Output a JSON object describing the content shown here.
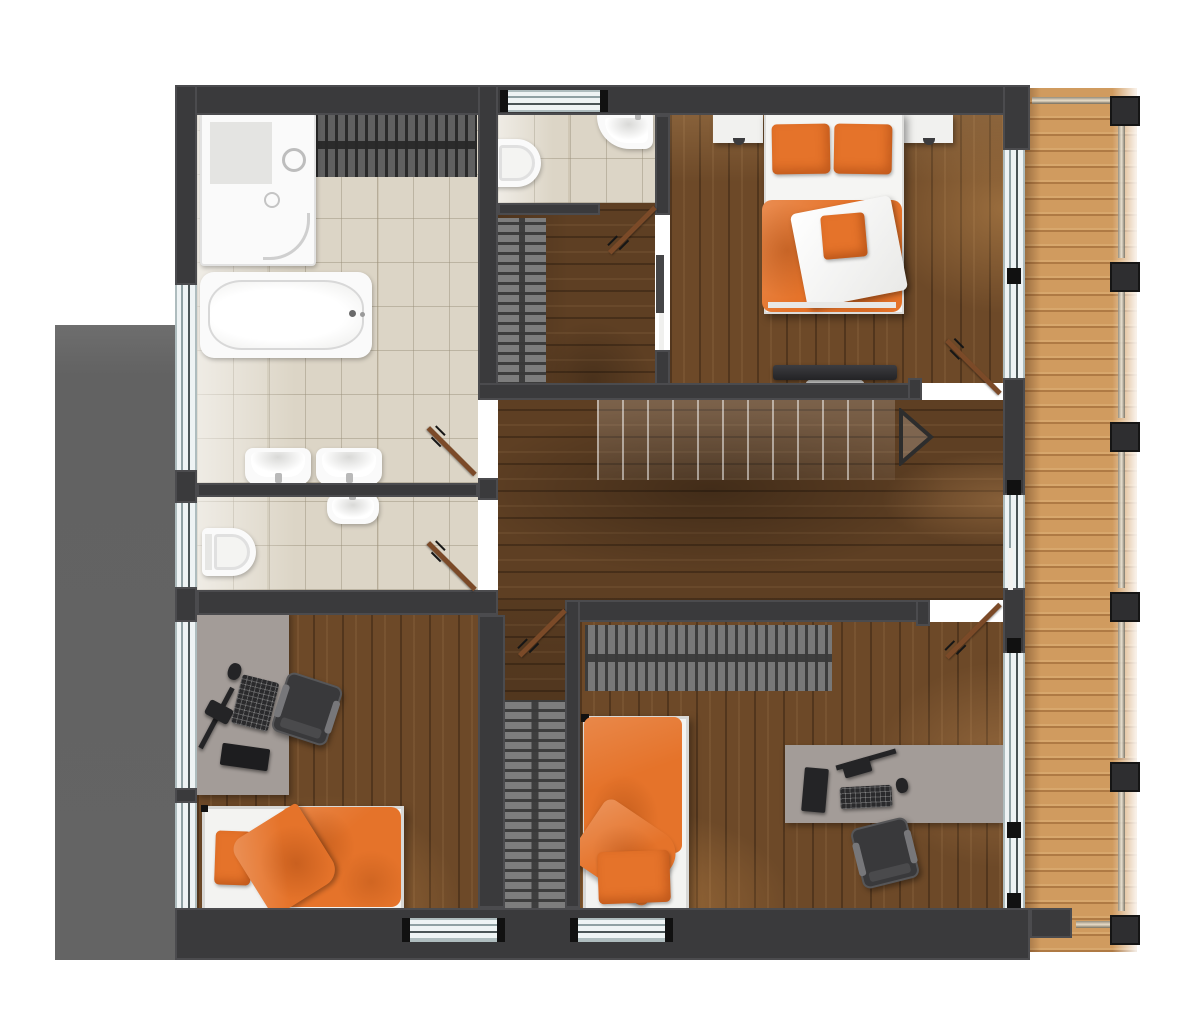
{
  "image": {
    "kind": "architectural floor plan render, top-down view, upper storey",
    "background": "#ffffff"
  },
  "palette": {
    "wall": "#3a3a3c",
    "tile_floor": "#dcd5c6",
    "wood_floor_rooms": "#6d4928",
    "wood_floor_hall": "#5e3f23",
    "balcony_deck": "#d09b5f",
    "accent_orange": "#e5732a",
    "desk_gray": "#a39c98",
    "wardrobe_gray": "#787878",
    "glass": "#eef3f4",
    "door_leaf": "#7b4a28",
    "side_panel_gray": "#646464"
  },
  "floor_plan": {
    "rooms": [
      {
        "id": "bathroom-main",
        "label": "main bathroom",
        "floor": "tile",
        "fixtures": [
          "walk-in shower",
          "bathtub",
          "double washbasins",
          "hanger wardrobe rail"
        ]
      },
      {
        "id": "wc-top",
        "label": "wc",
        "floor": "tile",
        "fixtures": [
          "toilet",
          "corner washbasin"
        ],
        "window": true
      },
      {
        "id": "bathroom-second",
        "label": "second bathroom",
        "floor": "tile",
        "fixtures": [
          "toilet",
          "washbasin"
        ]
      },
      {
        "id": "vestibule",
        "label": "dressing vestibule",
        "floor": "wood",
        "fixtures": [
          "hanger wardrobe rail",
          "sliding door"
        ]
      },
      {
        "id": "master-bedroom",
        "label": "master bedroom",
        "floor": "wood",
        "fixtures": [
          "double bed with orange bedding",
          "two nightstands",
          "wall-mounted tv"
        ]
      },
      {
        "id": "hallway",
        "label": "hallway landing",
        "floor": "wood",
        "fixtures": [
          "staircase",
          "direction arrow"
        ]
      },
      {
        "id": "bedroom-left",
        "label": "bedroom bottom-left",
        "floor": "wood",
        "fixtures": [
          "single bed with orange bedding",
          "desk with computer",
          "office chair"
        ]
      },
      {
        "id": "bedroom-right",
        "label": "bedroom bottom-right",
        "floor": "wood",
        "fixtures": [
          "single bed with orange bedding",
          "desk with computer",
          "office chair",
          "hanger wardrobe"
        ]
      },
      {
        "id": "walk-in-closet",
        "label": "hall closet strip",
        "floor": "wood",
        "fixtures": [
          "hanger wardrobe rail"
        ]
      },
      {
        "id": "balcony",
        "label": "balcony",
        "floor": "wood decking",
        "fixtures": [
          "railing with six posts",
          "top rail",
          "bottom rail"
        ]
      }
    ],
    "doors": [
      {
        "id": "door-bathroom-main",
        "swing": "into bathroom"
      },
      {
        "id": "door-bathroom-second",
        "swing": "into bathroom"
      },
      {
        "id": "door-wc",
        "swing": "into vestibule"
      },
      {
        "id": "door-closet",
        "swing": "into closet strip"
      },
      {
        "id": "door-master-bedroom",
        "swing": "into bedroom"
      },
      {
        "id": "door-bedroom-right",
        "swing": "into bedroom"
      }
    ],
    "stairs": {
      "treads": 12,
      "direction_arrow": "pointing right"
    },
    "beds": [
      {
        "id": "master-bed",
        "pillows": 2,
        "cushion": 1,
        "bedding": "orange with folded white blanket"
      },
      {
        "id": "bed-left",
        "pillows": 1,
        "bedding": "orange duvet, white mattress"
      },
      {
        "id": "bed-right",
        "pillows": 1,
        "bedding": "orange duvet, white mattress"
      }
    ],
    "desks": [
      {
        "id": "desk-left",
        "items": [
          "monitor",
          "keyboard",
          "mouse",
          "laptop"
        ]
      },
      {
        "id": "desk-right",
        "items": [
          "monitor",
          "keyboard",
          "mouse",
          "accessories"
        ]
      }
    ]
  }
}
